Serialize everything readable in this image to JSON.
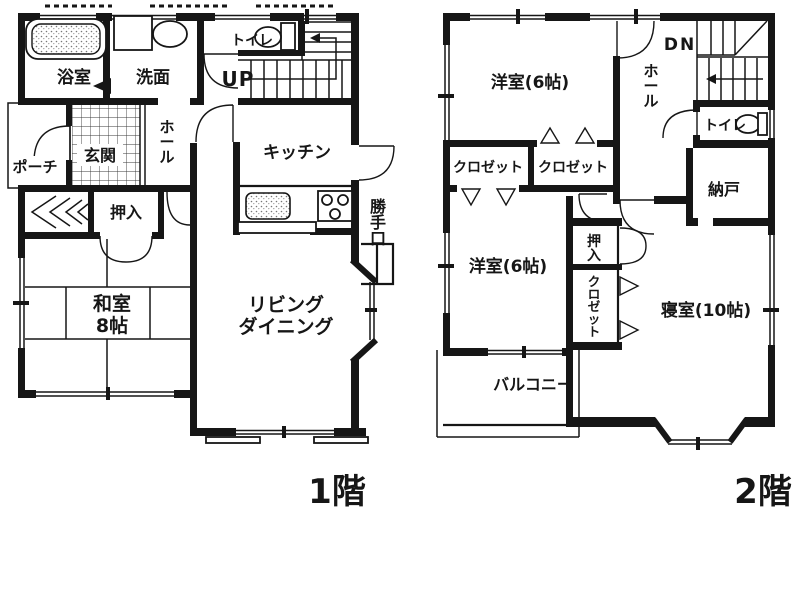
{
  "colors": {
    "background": "#ffffff",
    "ink": "#161616"
  },
  "floor1": {
    "title": "1階",
    "labels": {
      "bathroom": "浴室",
      "washroom": "洗面",
      "toilet": "トイレ",
      "stairs": "UP",
      "hall": "ホール",
      "kitchen": "キッチン",
      "entrance": "玄関",
      "porch": "ポーチ",
      "closet": "押入",
      "tatami_line1": "和室",
      "tatami_line2": "8帖",
      "living_line1": "リビング",
      "living_line2": "ダイニング",
      "backdoor": "勝手口"
    }
  },
  "floor2": {
    "title": "2階",
    "labels": {
      "western1": "洋室(6帖)",
      "stairs": "DN",
      "hall": "ホール",
      "toilet": "トイレ",
      "closet_a": "クロゼット",
      "closet_b": "クロゼット",
      "storage": "納戸",
      "western2": "洋室(6帖)",
      "oshiire": "押入",
      "closet_c": "クロゼット",
      "bedroom": "寝室(10帖)",
      "balcony": "バルコニー"
    }
  }
}
